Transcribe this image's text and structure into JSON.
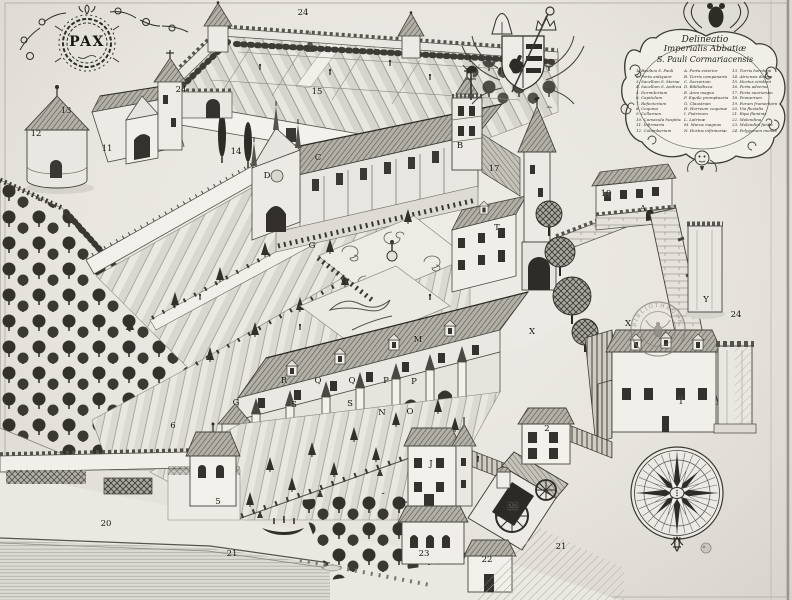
{
  "engraving": {
    "pax_motto": "PAX",
    "stamp_text": "BIBLIOTHEQUE IMPERIALE",
    "compass_points": 16,
    "colors": {
      "paper": "#e8e6e0",
      "ink": "#2e2c27",
      "roof_shade": "#8a887f",
      "stamp_ink": "#7d7b74"
    }
  },
  "cartouche": {
    "title_lines": [
      "Delineatio",
      "Imperialis Abbatiæ",
      "S. Pauli Cormariacensis"
    ],
    "legend_columns": [
      [
        "1. Basilica S. Pauli",
        "2. Porta antiquior",
        "3. Sacellum S. Mariæ",
        "4. Sacellum S. Andreæ",
        "5. Dormitorium",
        "6. Capitulum",
        "7. Refectorium",
        "8. Coquina",
        "9. Cellarium",
        "10. Cœnacula hospitum",
        "11. Infirmaria",
        "12. Columbarium"
      ],
      [
        "A. Porta exterior",
        "B. Turris campanaria",
        "C. Sacrarium",
        "D. Bibliotheca",
        "E. Area magna",
        "F. Equile promptuaria",
        "G. Claustrum",
        "H. Horreum coquinæ",
        "I. Pistrinum",
        "L. Latrinæ",
        "M. Murus magnus",
        "N. Hortus infirmariæ"
      ],
      [
        "13. Turris horologii",
        "14. Atriensis domus",
        "15. Hortus viridarii",
        "16. Porta adversa",
        "17. Porta suariorum",
        "18. Pomœrium",
        "19. Forum frumentarium",
        "20. Via fluvialis",
        "21. Ripa fluminis",
        "22. Molendina",
        "23. Molendini fanile",
        "24. Polygonum monasterii"
      ]
    ]
  },
  "map_labels": [
    {
      "t": "24",
      "x": 303,
      "y": 13
    },
    {
      "t": "24",
      "x": 181,
      "y": 90
    },
    {
      "t": "15",
      "x": 317,
      "y": 92
    },
    {
      "t": "13",
      "x": 66,
      "y": 111
    },
    {
      "t": "12",
      "x": 36,
      "y": 134
    },
    {
      "t": "11",
      "x": 107,
      "y": 149
    },
    {
      "t": "14",
      "x": 236,
      "y": 152
    },
    {
      "t": "17",
      "x": 494,
      "y": 169
    },
    {
      "t": "19",
      "x": 606,
      "y": 194
    },
    {
      "t": "A",
      "x": 643,
      "y": 209
    },
    {
      "t": "24",
      "x": 736,
      "y": 315
    },
    {
      "t": "Y",
      "x": 706,
      "y": 300
    },
    {
      "t": "X",
      "x": 628,
      "y": 324
    },
    {
      "t": "X",
      "x": 532,
      "y": 332
    },
    {
      "t": "1",
      "x": 681,
      "y": 402
    },
    {
      "t": "2",
      "x": 547,
      "y": 429
    },
    {
      "t": "J",
      "x": 431,
      "y": 464
    },
    {
      "t": "23",
      "x": 424,
      "y": 554
    },
    {
      "t": "22",
      "x": 513,
      "y": 507
    },
    {
      "t": "22",
      "x": 487,
      "y": 560
    },
    {
      "t": "21",
      "x": 561,
      "y": 547
    },
    {
      "t": "21",
      "x": 232,
      "y": 554
    },
    {
      "t": "20",
      "x": 106,
      "y": 524
    },
    {
      "t": "5",
      "x": 218,
      "y": 502
    },
    {
      "t": "6",
      "x": 173,
      "y": 426
    },
    {
      "t": "G",
      "x": 236,
      "y": 403
    },
    {
      "t": "B",
      "x": 460,
      "y": 146
    },
    {
      "t": "C",
      "x": 318,
      "y": 158
    },
    {
      "t": "D",
      "x": 267,
      "y": 176
    },
    {
      "t": "G",
      "x": 312,
      "y": 246
    },
    {
      "t": "T",
      "x": 497,
      "y": 228
    },
    {
      "t": "S",
      "x": 294,
      "y": 405
    },
    {
      "t": "S",
      "x": 350,
      "y": 404
    },
    {
      "t": "N",
      "x": 382,
      "y": 413
    },
    {
      "t": "O",
      "x": 410,
      "y": 412
    },
    {
      "t": "R",
      "x": 284,
      "y": 381
    },
    {
      "t": "Q",
      "x": 318,
      "y": 381
    },
    {
      "t": "Q",
      "x": 352,
      "y": 381
    },
    {
      "t": "P",
      "x": 386,
      "y": 381
    },
    {
      "t": "P",
      "x": 414,
      "y": 382
    },
    {
      "t": "M",
      "x": 418,
      "y": 340
    }
  ]
}
